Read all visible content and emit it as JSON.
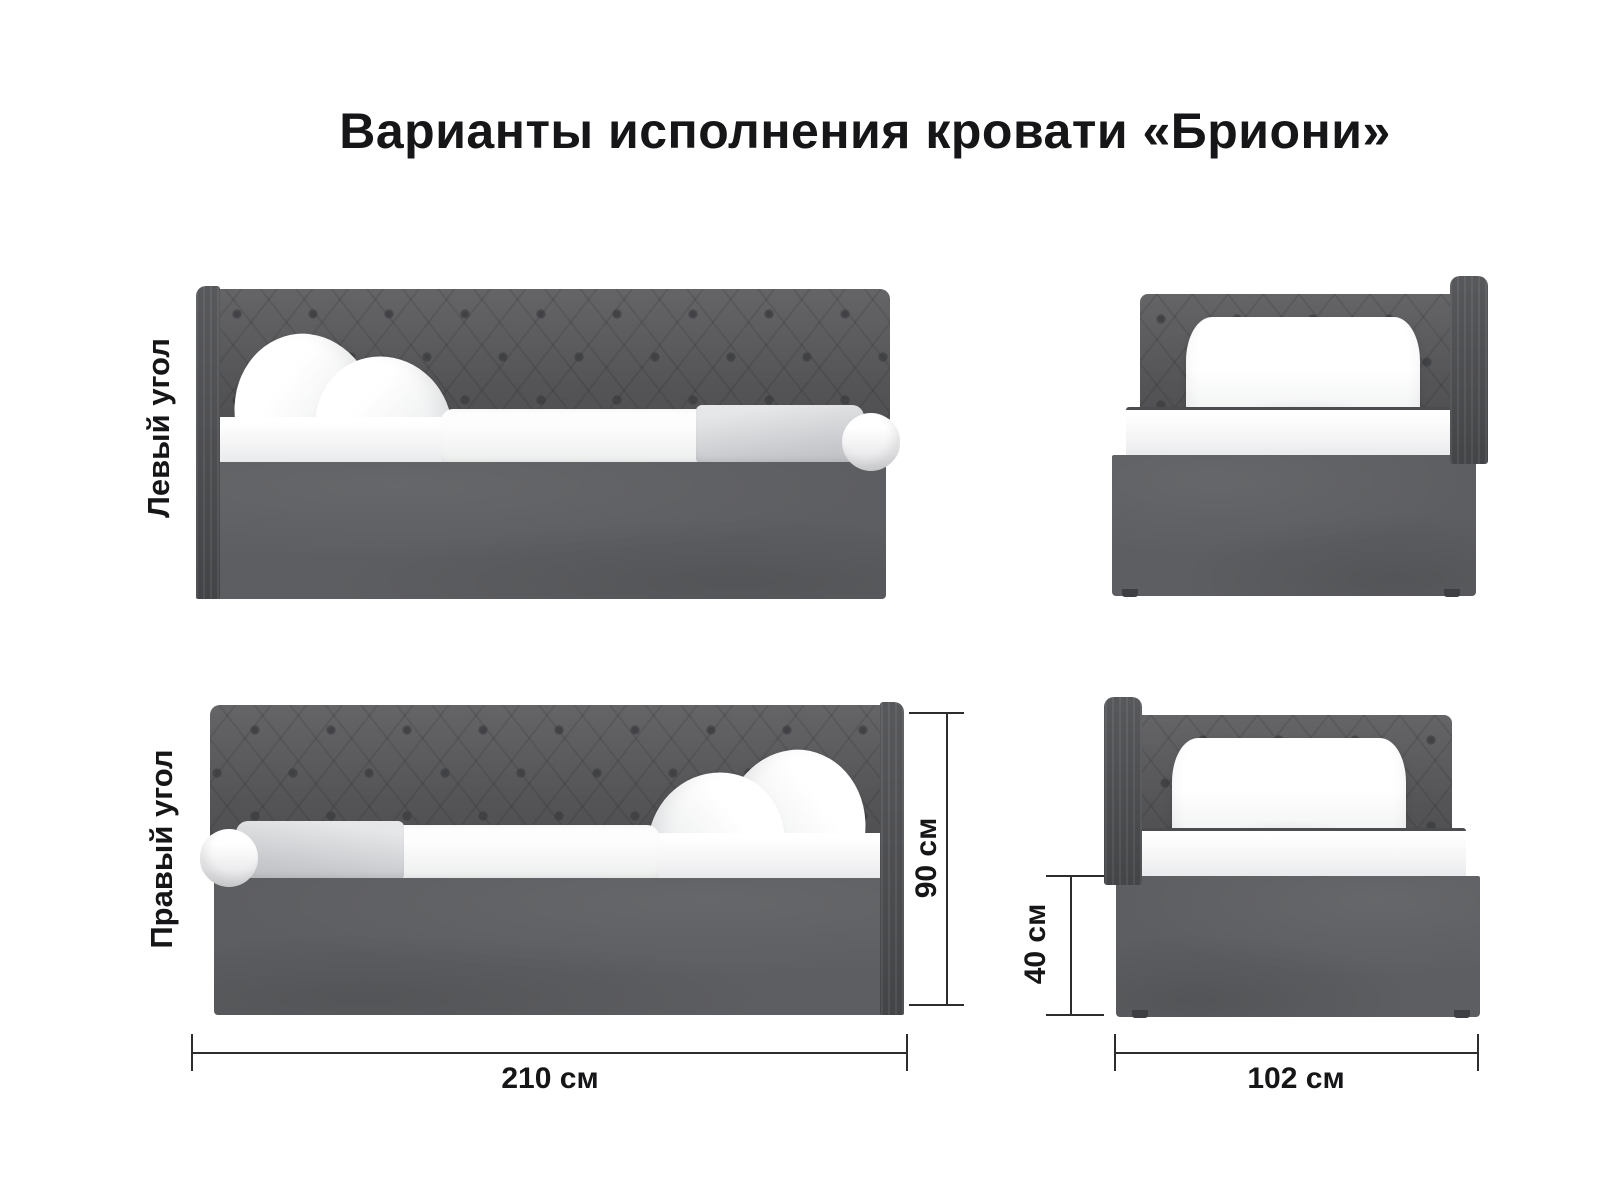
{
  "title": "Варианты исполнения кровати «Бриони»",
  "variants": [
    {
      "label": "Левый угол"
    },
    {
      "label": "Правый угол"
    }
  ],
  "dimensions": {
    "total_height": "90 см",
    "length": "210 см",
    "base_height": "40 см",
    "width": "102 см"
  },
  "colors": {
    "fabric_headboard": "#59595c",
    "fabric_post": "#4d4e51",
    "fabric_base": "#5d5e61",
    "button": "#404144",
    "bedding": "#ffffff",
    "blanket": "#c9cacd",
    "dimension_line": "#2c2d2f",
    "text": "#161618",
    "background": "#ffffff"
  }
}
